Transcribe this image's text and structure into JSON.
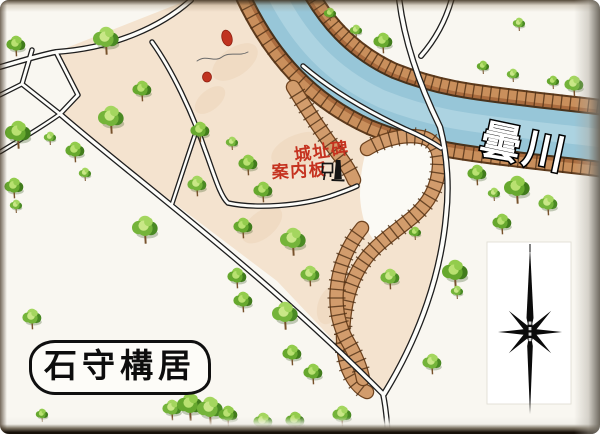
{
  "title_box": {
    "label": "石守構居"
  },
  "labels": {
    "river": "曇川",
    "monument": "城址碑",
    "sign": "案内板"
  },
  "icons": {
    "signboard": "signboard-icon",
    "monument": "monument-icon",
    "compass": "compass-rose"
  },
  "colors": {
    "land": "#f4e3cf",
    "land_patch": "#ecd3b8",
    "courtyard": "#fbfaf5",
    "bank_edge": "#5d3a1c",
    "bank_fill": "#c98f5c",
    "bank_inner": "#a96b3e",
    "river_edge": "#47321c",
    "river": "#97c6d8",
    "river_hl": "#c2e0ea",
    "moat_edge": "#6e431f",
    "moat_fill": "#d29c6c",
    "hatch": "#4f3015",
    "road_edge": "#1e1e1e",
    "road_fill": "#fdfdfa",
    "red_label": "#c5321f",
    "red_mark": "#c03320",
    "ink": "#0b0b0b"
  },
  "map": {
    "land": "M 188,0 L 256,0 C 271,25 286,47 303,65 C 332,91 369,112 405,129 C 421,136 435,142 443,149 C 448,172 448,194 446,217 C 441,272 421,334 384,394 L 277,281 L 150,185 L 60,114 L 78,95 L 56,52 Z",
    "land_patches": [
      [
        235,
        62,
        26,
        14,
        -35
      ],
      [
        300,
        150,
        30,
        16,
        -20
      ],
      [
        262,
        225,
        24,
        13,
        -40
      ],
      [
        330,
        305,
        20,
        12,
        -70
      ],
      [
        210,
        100,
        18,
        10,
        -40
      ]
    ],
    "river": "M 272,-14 C 298,40 332,76 382,99 C 432,119 472,123 522,129 C 562,134 586,136 606,139",
    "courtyard": "M 366,152 C 380,142 402,135 420,136 C 432,138 437,147 437,160 C 436,178 431,193 419,206 C 405,220 388,230 374,240 C 366,231 361,215 360,196 C 360,180 362,164 366,152 Z",
    "moat": [
      "M 293,87 C 306,108 324,136 341,158 C 347,166 351,173 354,180",
      "M 367,149 C 383,139 407,133 425,138 C 436,142 440,152 439,166 C 438,186 429,203 413,217 C 396,231 378,243 367,257 C 355,272 348,291 345,311 C 342,331 342,352 348,369 C 353,381 360,389 367,392",
      "M 362,228 C 348,245 339,266 337,288 C 335,308 339,327 348,342 C 355,354 361,367 363,379"
    ],
    "trail": "M 197,61 C 207,54 214,63 222,57 C 230,51 239,57 248,52",
    "red_marks": [
      [
        227,
        38,
        5,
        8,
        -15
      ],
      [
        207,
        77,
        4.5,
        5,
        0
      ]
    ],
    "roads": [
      {
        "d": "M 191,0 C 162,26 115,48 56,52 C 36,56 18,62 0,67",
        "w": 6
      },
      {
        "d": "M 56,52 L 78,95 L 60,114 L 22,84 L 32,50",
        "w": 5.5
      },
      {
        "d": "M 22,84 C 14,88 6,92 0,95",
        "w": 5
      },
      {
        "d": "M 60,114 C 130,175 260,270 383,394",
        "w": 6
      },
      {
        "d": "M 60,114 C 42,127 20,140 0,152",
        "w": 5
      },
      {
        "d": "M 383,394 C 386,408 387,420 388,436",
        "w": 6
      },
      {
        "d": "M 399,-2 C 404,40 419,84 440,127 C 448,158 449,190 446,216 C 441,272 421,334 384,394",
        "w": 6.5
      },
      {
        "d": "M 452,-2 C 446,20 435,40 421,56",
        "w": 6
      },
      {
        "d": "M 152,42 C 172,70 192,112 205,150 C 214,174 220,196 228,203 C 256,209 300,206 331,196 C 342,192 351,189 357,186",
        "w": 5.5
      },
      {
        "d": "M 197,129 C 188,155 179,183 172,204",
        "w": 5
      },
      {
        "d": "M 303,66 C 331,90 369,112 405,129 C 419,135 432,142 441,148",
        "w": 5.5
      }
    ],
    "trees": [
      [
        16,
        44,
        1
      ],
      [
        106,
        38,
        2
      ],
      [
        142,
        89,
        1
      ],
      [
        111,
        117,
        2
      ],
      [
        18,
        132,
        2
      ],
      [
        50,
        137,
        0
      ],
      [
        75,
        150,
        1
      ],
      [
        85,
        173,
        0
      ],
      [
        14,
        186,
        1
      ],
      [
        16,
        205,
        0
      ],
      [
        330,
        13,
        0
      ],
      [
        356,
        30,
        0
      ],
      [
        383,
        41,
        1
      ],
      [
        519,
        23,
        0
      ],
      [
        483,
        66,
        0
      ],
      [
        513,
        74,
        0
      ],
      [
        553,
        81,
        0
      ],
      [
        574,
        84,
        1
      ],
      [
        200,
        130,
        1
      ],
      [
        232,
        142,
        0
      ],
      [
        248,
        163,
        1
      ],
      [
        197,
        184,
        1
      ],
      [
        263,
        190,
        1
      ],
      [
        145,
        227,
        2
      ],
      [
        243,
        226,
        1
      ],
      [
        293,
        239,
        2
      ],
      [
        237,
        276,
        1
      ],
      [
        310,
        274,
        1
      ],
      [
        243,
        300,
        1
      ],
      [
        285,
        313,
        2
      ],
      [
        292,
        353,
        1
      ],
      [
        32,
        317,
        1
      ],
      [
        415,
        232,
        0
      ],
      [
        390,
        277,
        1
      ],
      [
        455,
        271,
        2
      ],
      [
        457,
        291,
        0
      ],
      [
        477,
        173,
        1
      ],
      [
        494,
        193,
        0
      ],
      [
        517,
        187,
        2
      ],
      [
        548,
        203,
        1
      ],
      [
        502,
        222,
        1
      ],
      [
        432,
        362,
        1
      ],
      [
        313,
        372,
        1
      ],
      [
        342,
        414,
        1
      ],
      [
        42,
        414,
        0
      ],
      [
        172,
        408,
        1
      ],
      [
        190,
        404,
        2
      ],
      [
        210,
        408,
        2
      ],
      [
        228,
        414,
        1
      ],
      [
        263,
        421,
        1
      ],
      [
        295,
        420,
        1
      ]
    ]
  }
}
